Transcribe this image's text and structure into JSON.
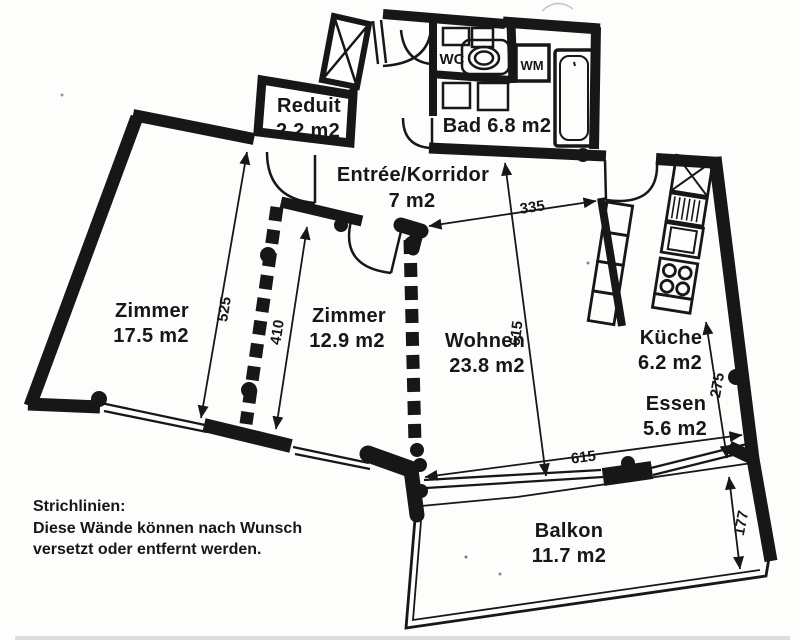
{
  "rooms": {
    "zimmer_links": {
      "name": "Zimmer",
      "area": "17.5 m2"
    },
    "zimmer_mitte": {
      "name": "Zimmer",
      "area": "12.9 m2"
    },
    "wohnen": {
      "name": "Wohnen",
      "area": "23.8 m2"
    },
    "kueche": {
      "name": "Küche",
      "area": "6.2 m2"
    },
    "essen": {
      "name": "Essen",
      "area": "5.6 m2"
    },
    "balkon": {
      "name": "Balkon",
      "area": "11.7 m2"
    },
    "bad": {
      "name": "Bad 6.8 m2"
    },
    "reduit": {
      "name": "Reduit",
      "area": "2.2 m2"
    },
    "entree": {
      "name": "Entrée/Korridor",
      "area": "7 m2"
    }
  },
  "fixtures": {
    "wc_label": "WC",
    "wm_label": "WM"
  },
  "dimensions": {
    "zimmer_links_tiefe": "525",
    "zimmer_mitte_tiefe": "410",
    "wohnen_breite": "335",
    "wohnen_tiefe": "615",
    "fensterfront_breite": "615",
    "essen_tiefe": "275",
    "balkon_tiefe": "177"
  },
  "note": {
    "lines": [
      "Strichlinien:",
      "Diese Wände können nach Wunsch",
      "versetzt oder entfernt werden."
    ]
  },
  "colors": {
    "ink": "#171717",
    "paper": "#fdfdfc"
  }
}
